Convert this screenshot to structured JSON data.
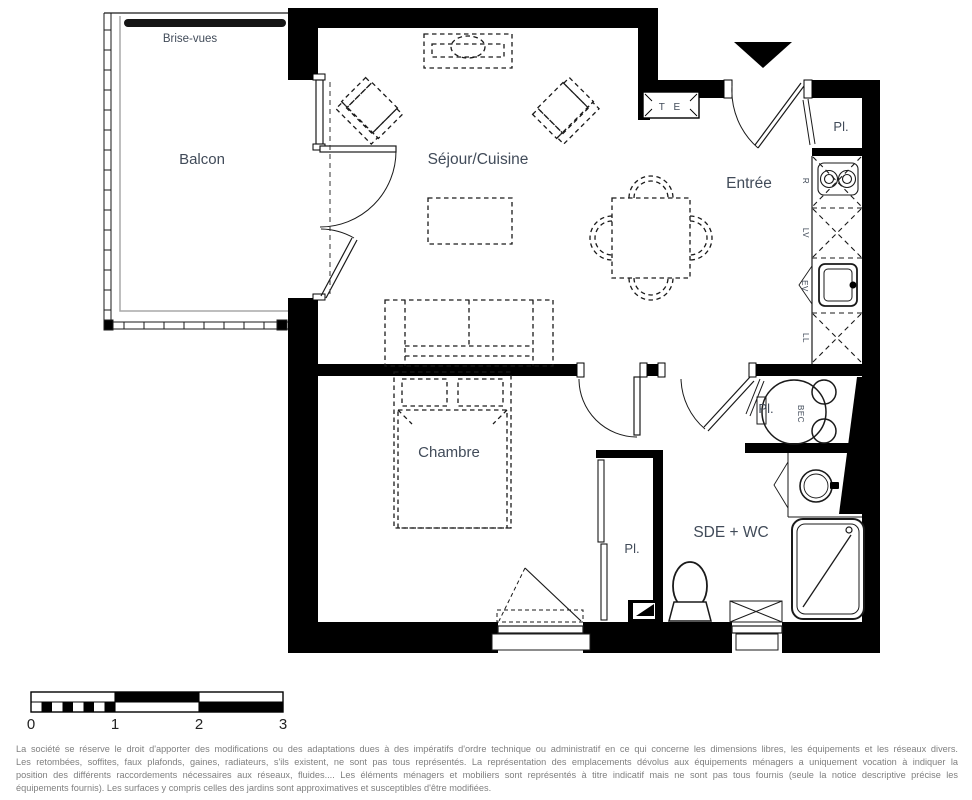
{
  "colors": {
    "wall": "#000000",
    "label_text": "#414b59",
    "disclaimer_text": "#7f7f7f",
    "balcony_screen_bar": "#151515"
  },
  "plan": {
    "balcony": {
      "label": "Balcon",
      "screen_label": "Brise-vues"
    },
    "living": {
      "label": "Séjour/Cuisine"
    },
    "entrance": {
      "label": "Entrée",
      "electrical_box": "T E",
      "closet": "Pl."
    },
    "kitchen": {
      "fridge": "R",
      "dishwasher": "LV",
      "sink": "EV",
      "washer": "LL"
    },
    "bathroom": {
      "label": "SDE + WC",
      "water_heater": "BEC",
      "closet": "Pl."
    },
    "bedroom": {
      "label": "Chambre",
      "closet": "Pl."
    }
  },
  "scale_bar": {
    "ticks": [
      "0",
      "1",
      "2",
      "3"
    ]
  },
  "disclaimer": {
    "lines": [
      "La société se réserve le droit d'apporter des modifications ou des adaptations dues à des impératifs d'ordre technique ou administratif en ce qui concerne les dimensions libres, les équipements et les réseaux divers.",
      "Les retombées, soffites, faux plafonds, gaines, radiateurs, s'ils existent, ne sont pas tous représentés. La représentation des emplacements dévolus aux équipements ménagers a uniquement vocation à indiquer la",
      "position des différents raccordements nécessaires aux réseaux, fluides.... Les éléments ménagers et mobiliers sont représentés à titre indicatif mais ne sont pas tous fournis (seule la notice descriptive précise les",
      "équipements fournis). Les surfaces y compris celles des jardins sont approximatives et susceptibles d'être modifiées."
    ]
  }
}
